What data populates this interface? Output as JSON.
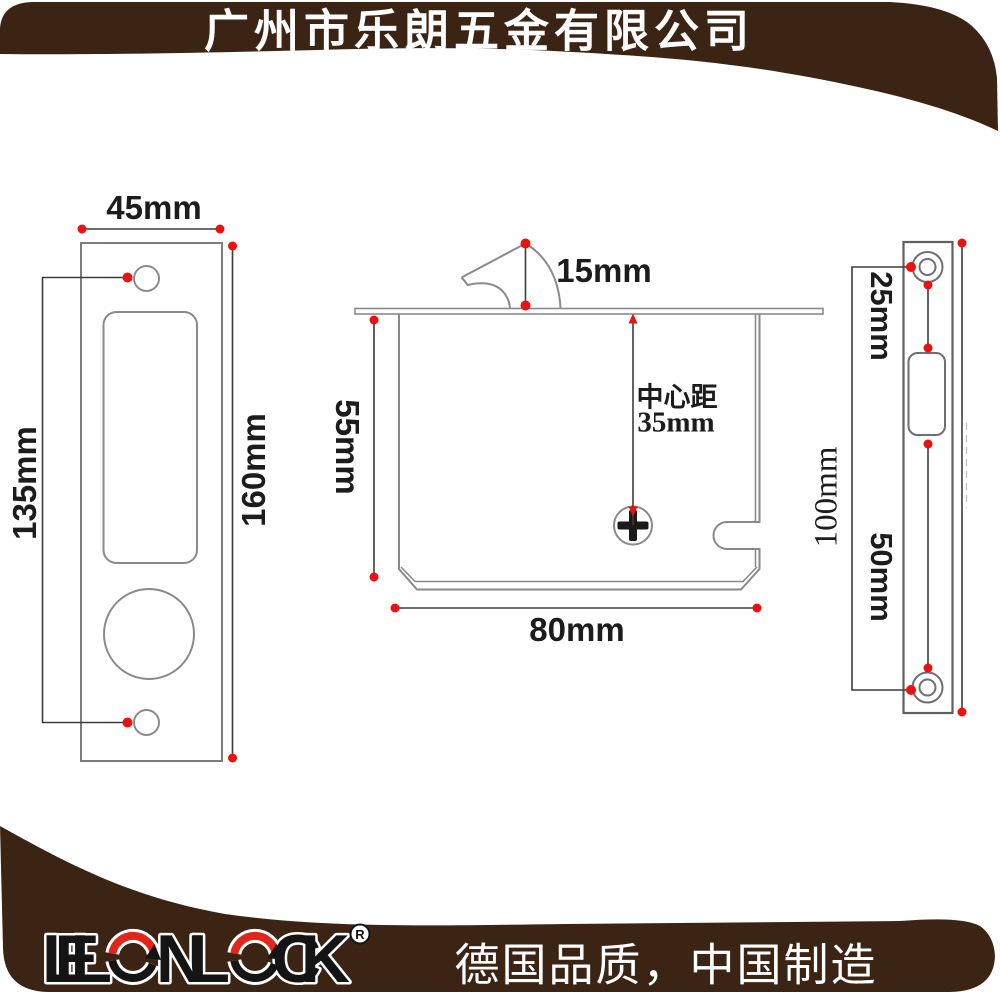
{
  "header": {
    "company_name": "广州市乐朗五金有限公司"
  },
  "footer": {
    "brand": "LELONLOCK",
    "registered_mark": "R",
    "tagline": "德国品质，中国制造"
  },
  "views": {
    "faceplate": {
      "width_label": "45mm",
      "hole_spacing_label": "135mm",
      "height_label": "160mm"
    },
    "lock_body": {
      "hook_label": "15mm",
      "depth_label": "55mm",
      "center_distance_caption": "中心距",
      "center_distance_value": "35mm",
      "width_label": "80mm"
    },
    "edge_plate": {
      "top_to_slot_label": "25mm",
      "slot_to_screw_label": "50mm",
      "screw_spacing_label": "100mm"
    }
  },
  "colors": {
    "banner_brown": "#3b2413",
    "accent_red": "#ee0f0f",
    "outline_gray": "#8a8a8a",
    "dimension_gray": "#3c3c3c",
    "text_white": "#ffffff"
  }
}
